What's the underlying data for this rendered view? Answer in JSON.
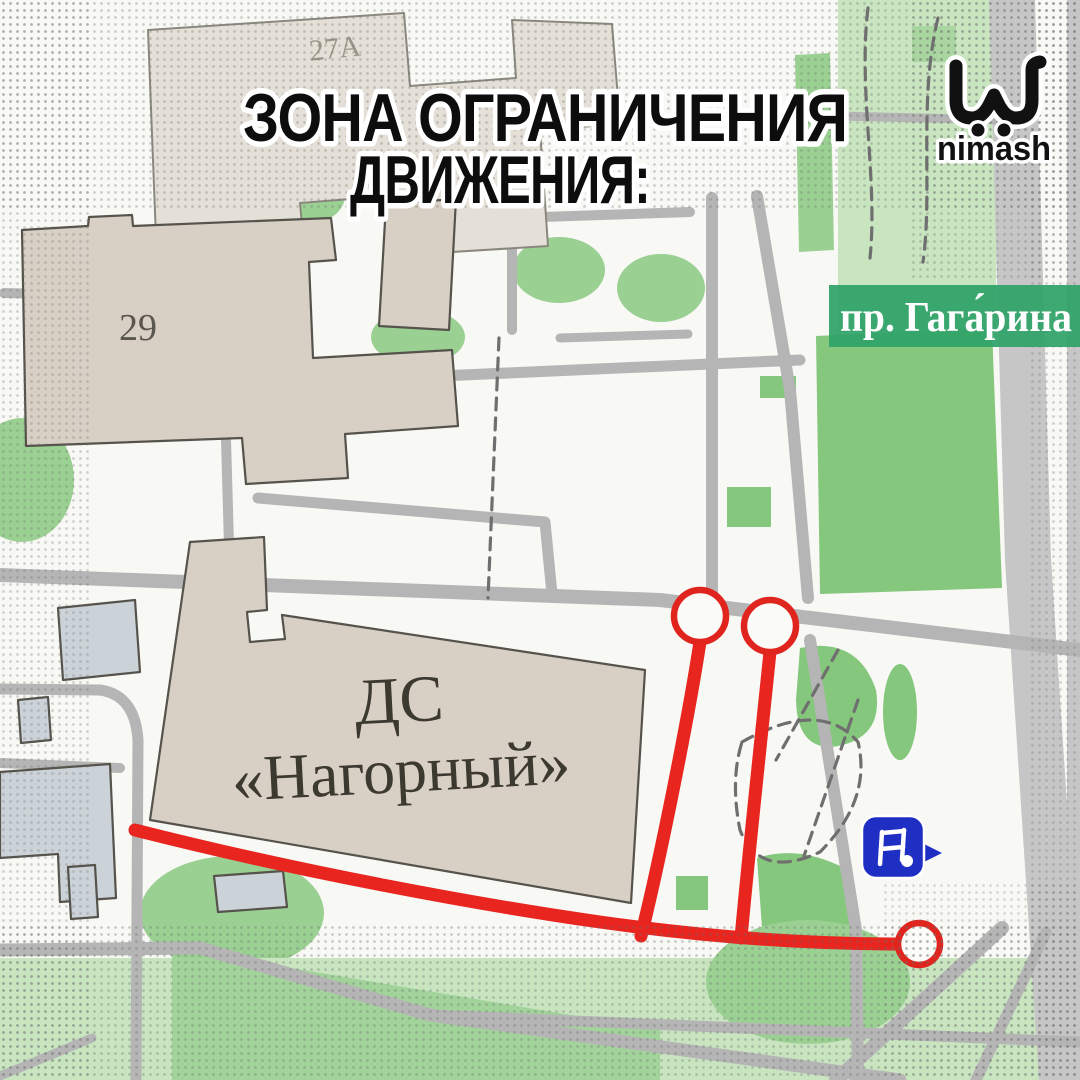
{
  "post": {
    "title_line1": "ЗОНА ОГРАНИЧЕНИЯ",
    "title_line2": "ДВИЖЕНИЯ:",
    "brand": "nimash"
  },
  "map": {
    "street_banner": "пр. Гага́рина",
    "labels": {
      "building_27a": "27А",
      "building_29": "29",
      "venue_line1": "ДС",
      "venue_line2": "«Нагорный»"
    },
    "marker": "sports-venue",
    "route_endpoint_count": "3"
  },
  "colors": {
    "restriction_red": "#E8251F",
    "banner_green": "#2FA268",
    "marker_blue": "#1F2FC4",
    "building_beige": "#D9D0C5",
    "park_green": "#85C77D",
    "road_gray": "#B5B5B5"
  }
}
